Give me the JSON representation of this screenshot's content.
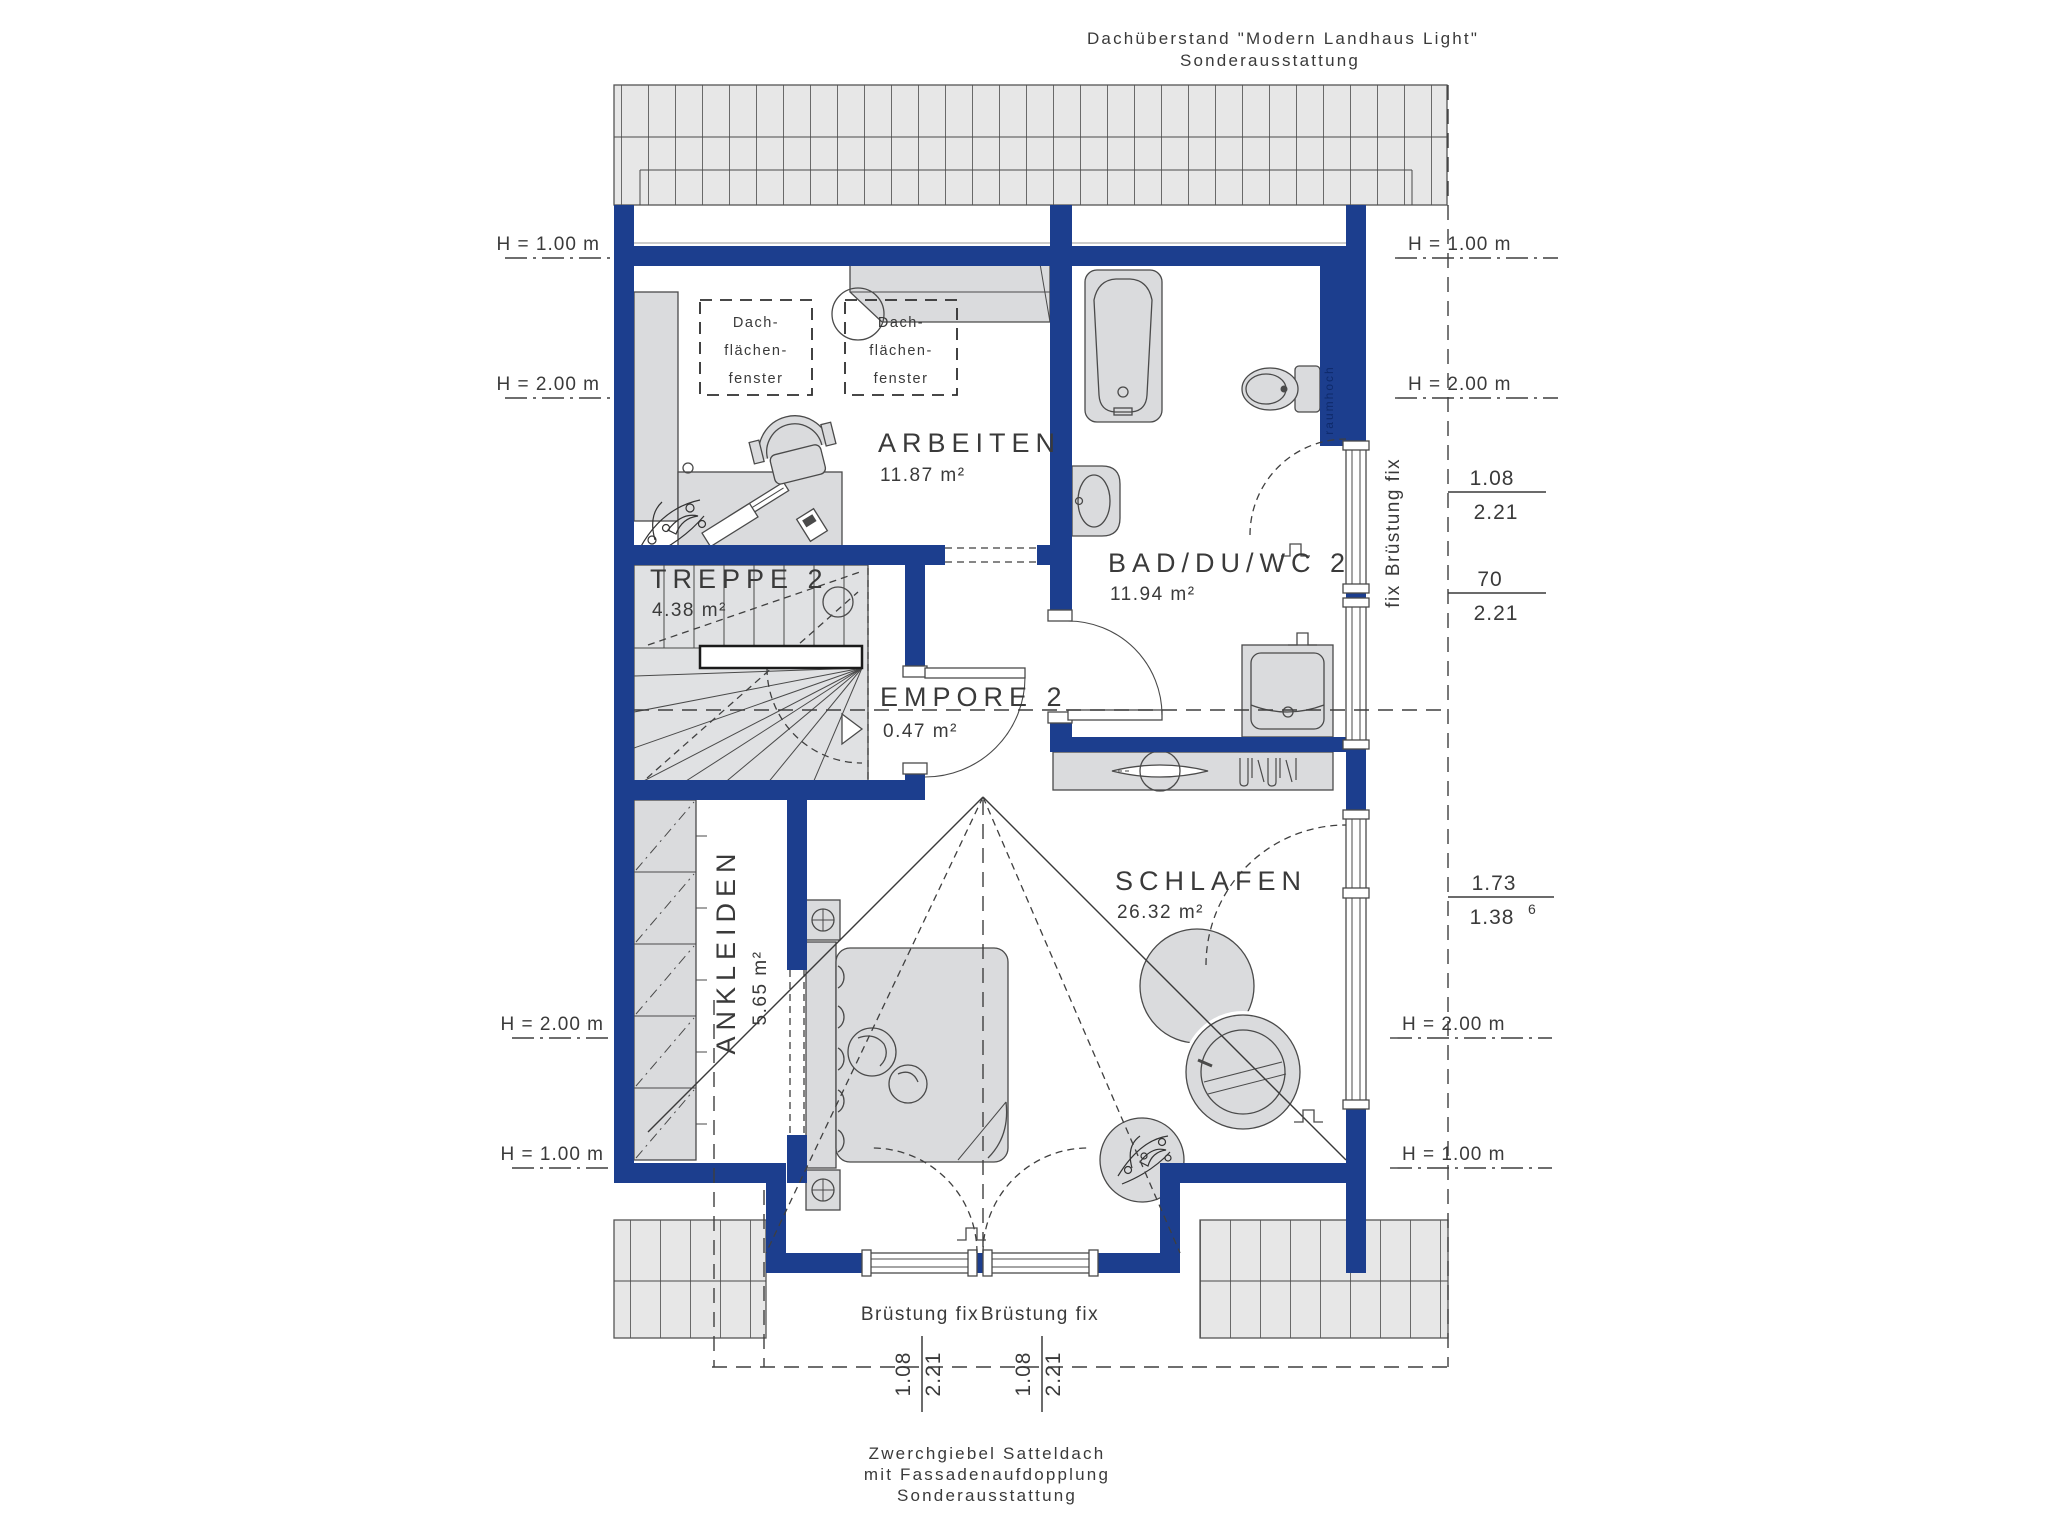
{
  "annotations": {
    "roof_top_line1": "Dachüberstand \"Modern Landhaus Light\"",
    "roof_top_line2": "Sonderausstattung",
    "bottom_line1": "Zwerchgiebel Satteldach",
    "bottom_line2": "mit Fassadenaufdopplung",
    "bottom_line3": "Sonderausstattung"
  },
  "rooms": {
    "arbeiten": {
      "name": "ARBEITEN",
      "area": "11.87 m²"
    },
    "bad": {
      "name": "BAD/DU/WC 2",
      "area": "11.94 m²"
    },
    "treppe": {
      "name": "TREPPE 2",
      "area": "4.38 m²"
    },
    "empore": {
      "name": "EMPORE 2",
      "area": "0.47 m²"
    },
    "ankleiden": {
      "name": "ANKLEIDEN",
      "area": "5.65 m²"
    },
    "schlafen": {
      "name": "SCHLAFEN",
      "area": "26.32 m²"
    }
  },
  "labels": {
    "h100": "H = 1.00 m",
    "h200": "H = 2.00 m",
    "bruestung_fix": "Brüstung fix",
    "fix": "fix",
    "raumhoch": "raumhoch",
    "skylight_line1": "Dach-",
    "skylight_line2": "flächen-",
    "skylight_line3": "fenster"
  },
  "dimensions": {
    "right1": {
      "num": "1.08",
      "den": "2.21"
    },
    "right2": {
      "num": "70",
      "den": "2.21"
    },
    "right3": {
      "num": "1.73",
      "den": "1.38",
      "den_sup": "6"
    },
    "bottom1": {
      "num": "1.08",
      "den": "2.21"
    },
    "bottom2": {
      "num": "1.08",
      "den": "2.21"
    }
  },
  "colors": {
    "wall": "#1c3e8e",
    "furniture": "#dadbdd",
    "roof_hatch": "#e7e7e7",
    "line": "#3f3f3f"
  }
}
